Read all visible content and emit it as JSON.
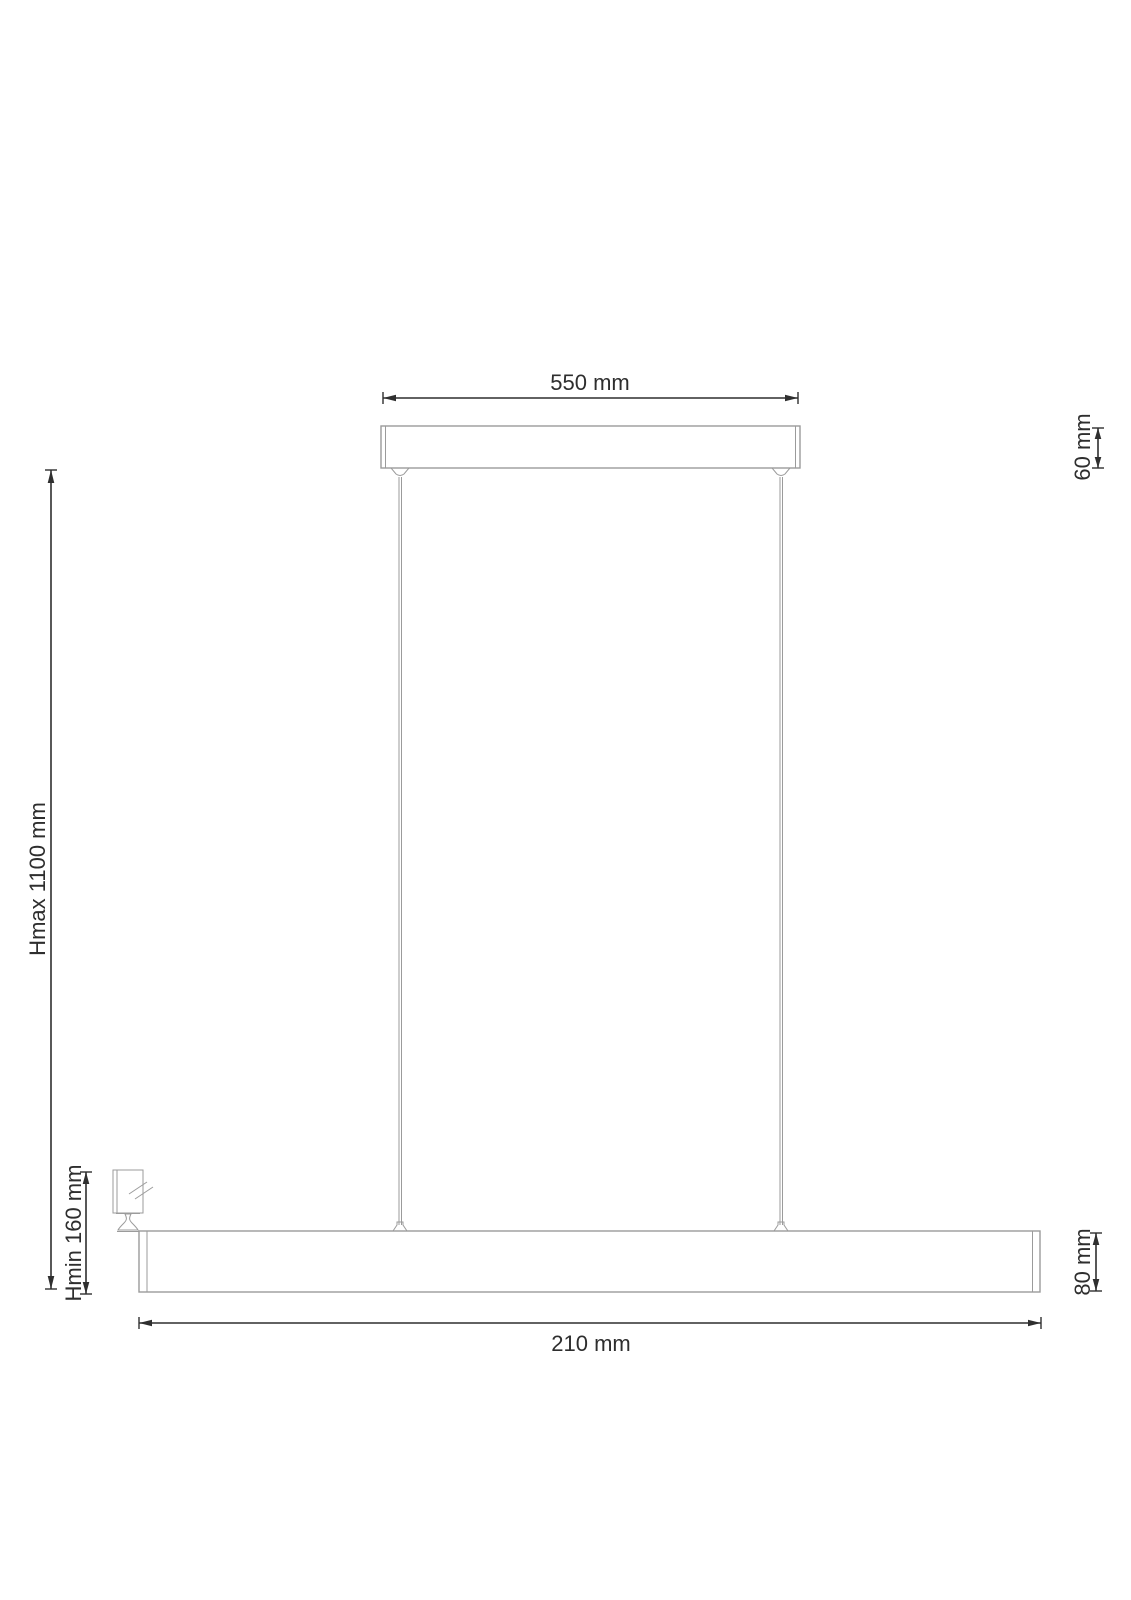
{
  "diagram": {
    "type": "technical-dimension-drawing",
    "subject": "linear-pendant-lamp",
    "labels": {
      "canopy_width": "550 mm",
      "canopy_height": "60 mm",
      "max_hanging_height": "Hmax 1100 mm",
      "min_hanging_height": "Hmin 160 mm",
      "bar_height": "80 mm",
      "bar_width": "210 mm"
    },
    "icons": {
      "bulb_symbol": "g9-bulb-icon"
    },
    "colors": {
      "background": "#ffffff",
      "outline": "#9b9b9b",
      "dimension_lines": "#2f2f2f",
      "text": "#2e2e2e"
    }
  }
}
